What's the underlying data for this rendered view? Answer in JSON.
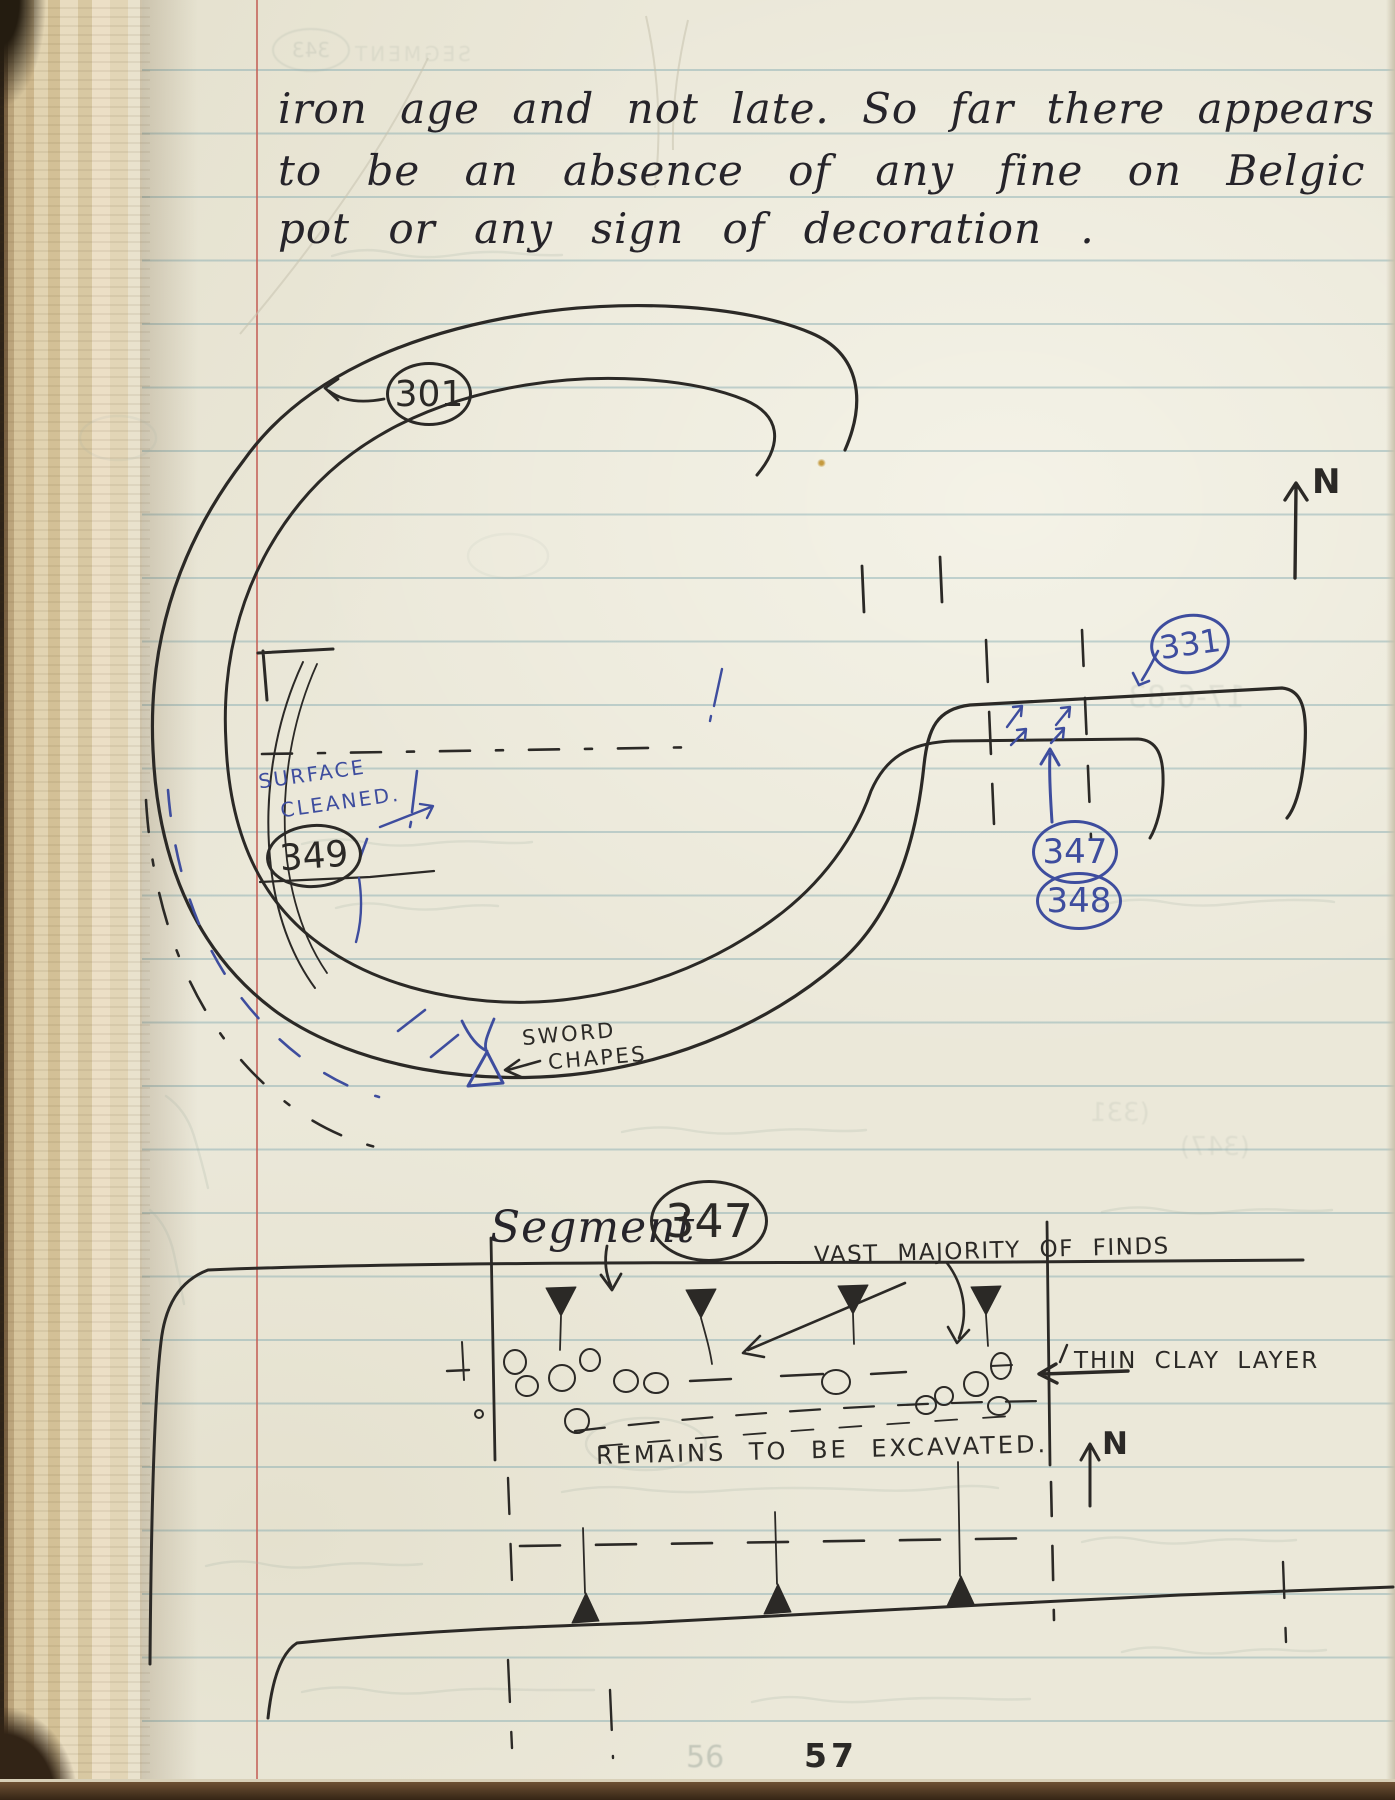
{
  "handwriting": {
    "line1": "iron age and not late. So far there appears",
    "line2": "to be an absence of any fine on Belgic",
    "line3": "pot or any sign of decoration ."
  },
  "plan_drawing": {
    "ditch_label": "301",
    "surface_cleaned_line1": "SURFACE",
    "surface_cleaned_line2": "CLEANED.",
    "segment_label_349": "349",
    "sword_chapes_line1": "SWORD",
    "sword_chapes_line2": "CHAPES",
    "terminal_label_331": "331",
    "terminal_label_347": "347",
    "terminal_label_348": "348",
    "north_label": "N"
  },
  "section_drawing": {
    "heading_word": "Segment",
    "heading_label": "347",
    "finds_note": "VAST MAJORITY OF FINDS",
    "clay_note": "THIN CLAY LAYER",
    "excavation_note": "REMAINS TO BE EXCAVATED.",
    "north_label": "N"
  },
  "page_footer": {
    "page_number": "57",
    "ghost_page_number": "56"
  },
  "ghost_showthrough": {
    "top_left_caps": "SEGMENT",
    "top_oval_number": "343",
    "date_fragment": "17-6-83",
    "number_fragment_1": "(331",
    "number_fragment_2": "(347)"
  },
  "colors": {
    "paper": "#ebe8d9",
    "ruled_line": "#80a8af",
    "margin_line": "#c4635a",
    "black_ink": "#2b2926",
    "blue_ink": "#3e4d9e",
    "binding_tan": "#d3c19b"
  }
}
